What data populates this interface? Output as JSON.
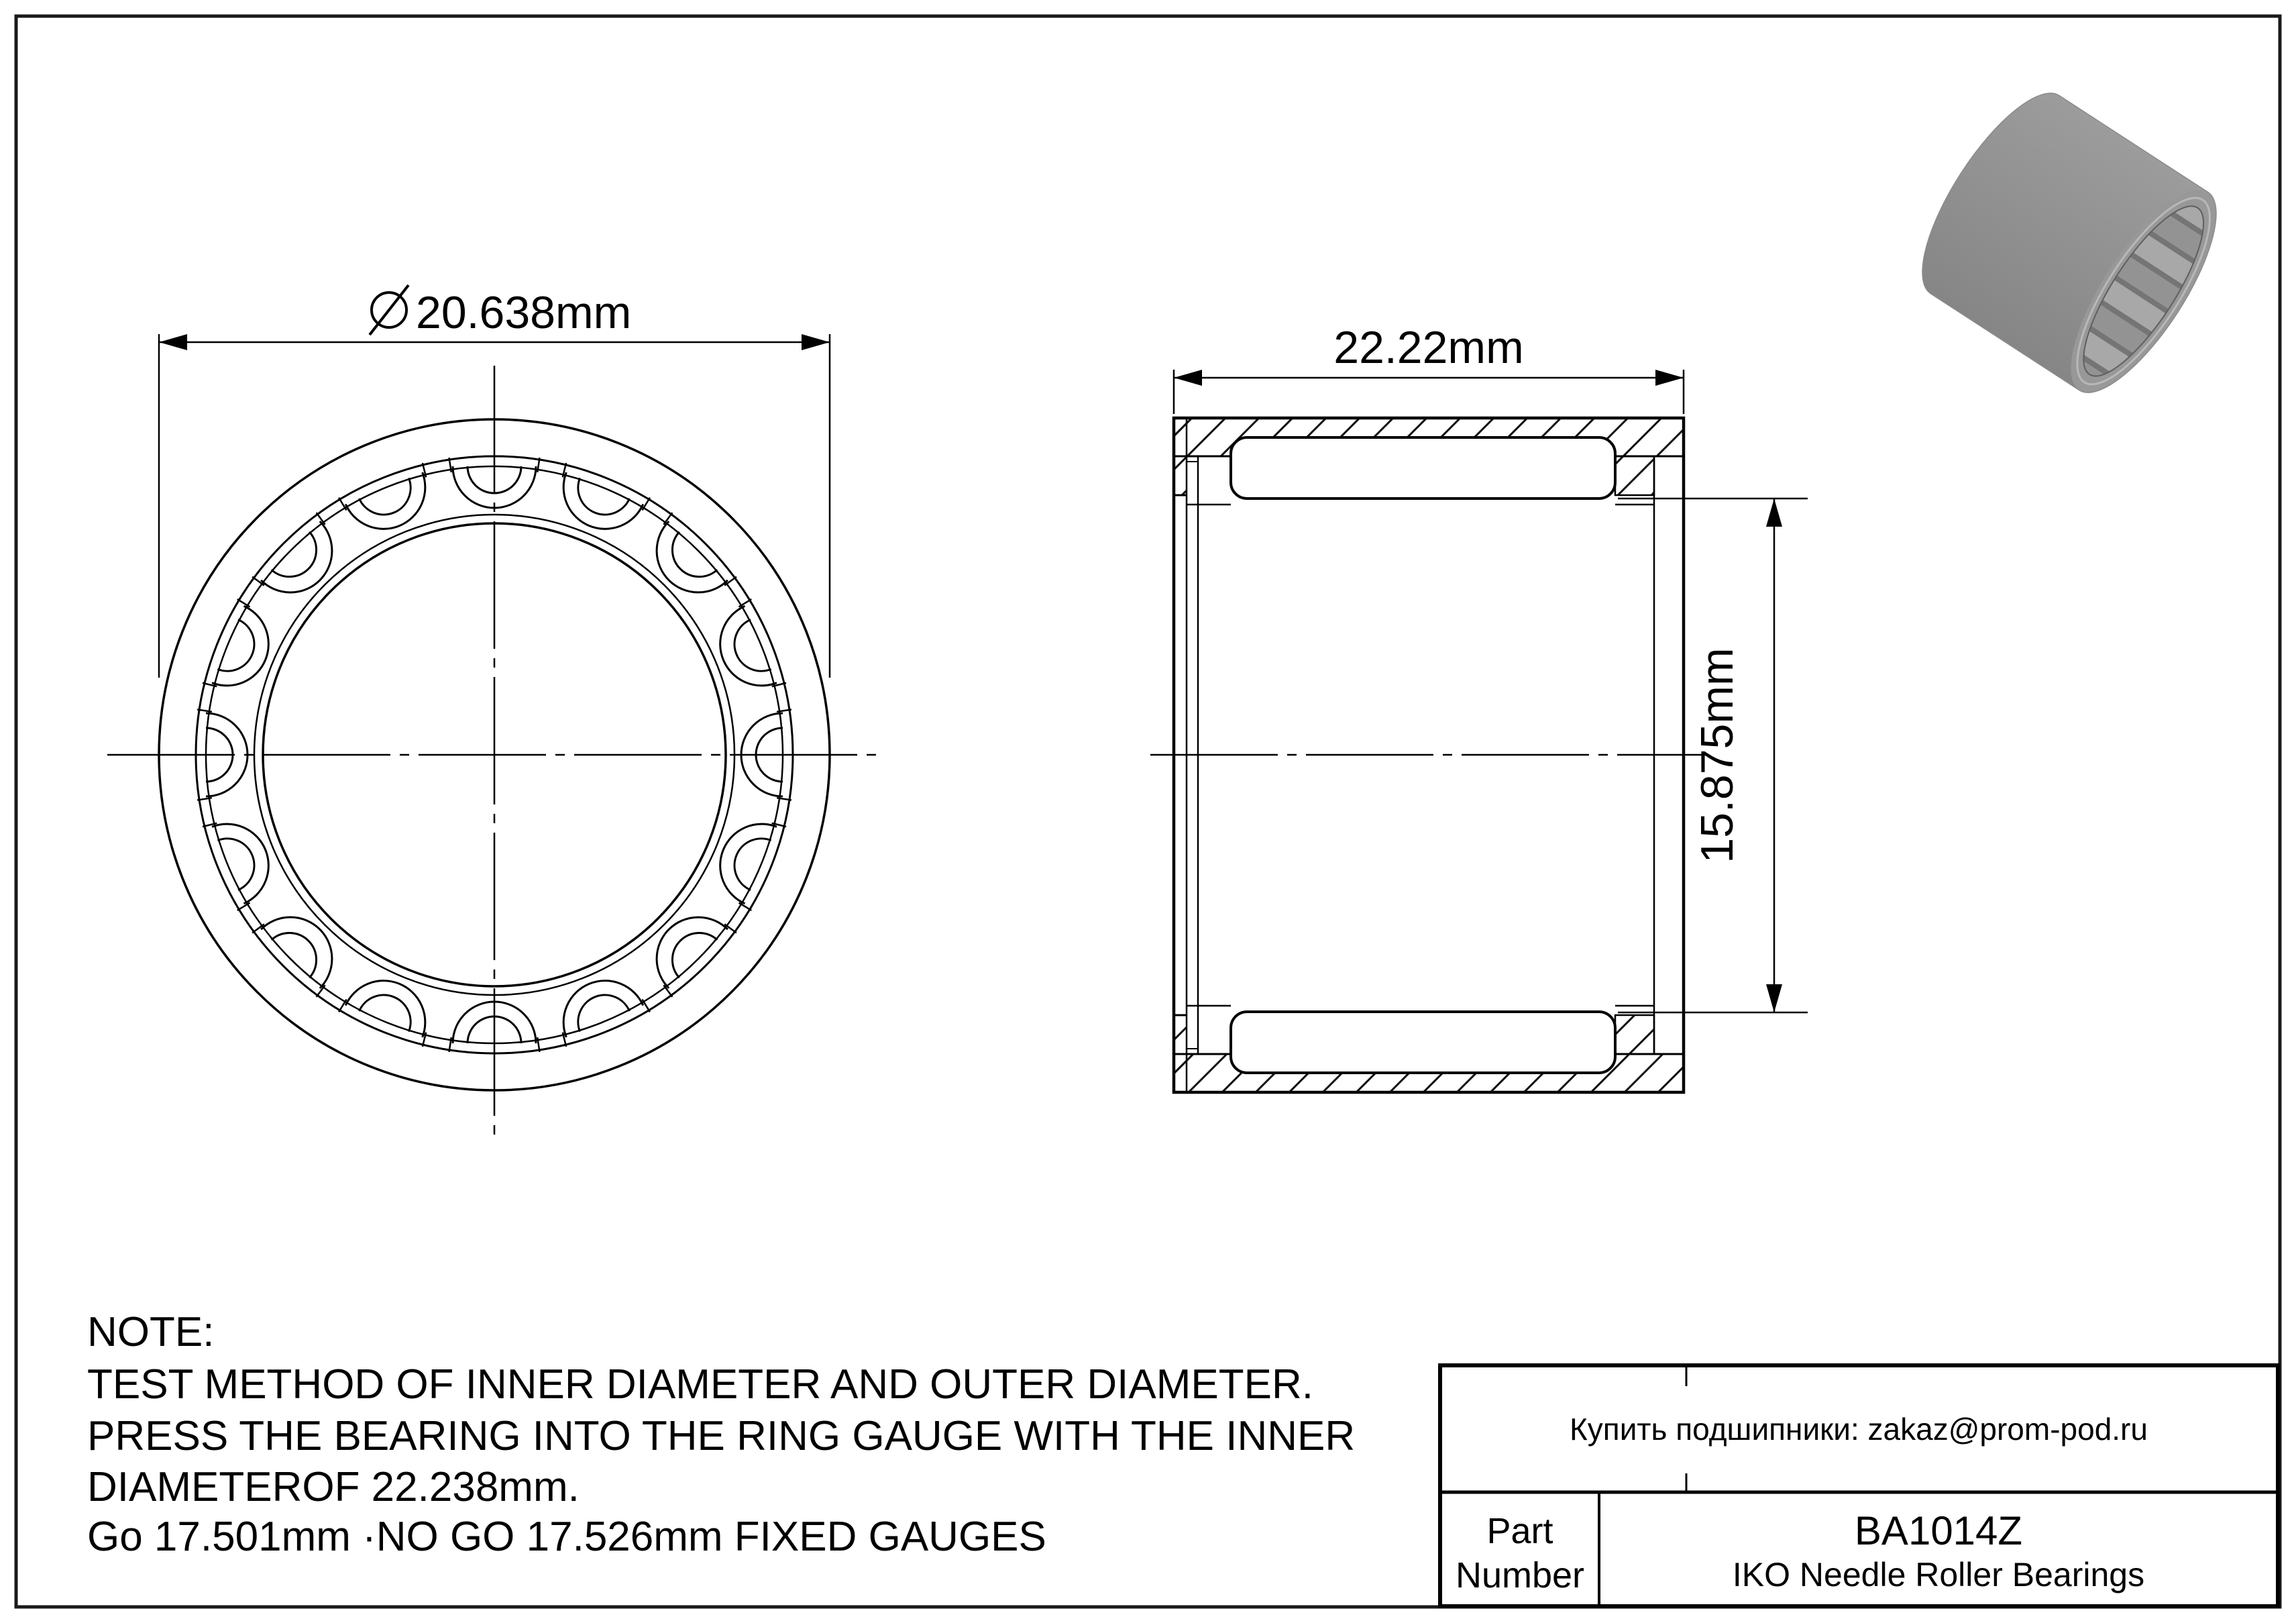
{
  "drawing": {
    "front_view": {
      "diameter_label": "20.638mm"
    },
    "section_view": {
      "width_label": "22.22mm",
      "bore_label": "15.875mm"
    }
  },
  "note": {
    "heading": "NOTE:",
    "lines": [
      "TEST METHOD OF INNER DIAMETER AND OUTER DIAMETER.",
      "PRESS THE BEARING INTO THE RING GAUGE WITH THE INNER",
      "DIAMETEROF 22.238mm.",
      "Go 17.501mm ·NO GO 17.526mm FIXED GAUGES"
    ]
  },
  "title_block": {
    "contact": "Купить подшипники: zakaz@prom-pod.ru",
    "part_label_line1": "Part",
    "part_label_line2": "Number",
    "part_number": "BA1014Z",
    "series": "IKO Needle Roller Bearings"
  },
  "colors": {
    "line": "#000000",
    "background": "#ffffff",
    "render_gray": "#a0a0a0"
  }
}
